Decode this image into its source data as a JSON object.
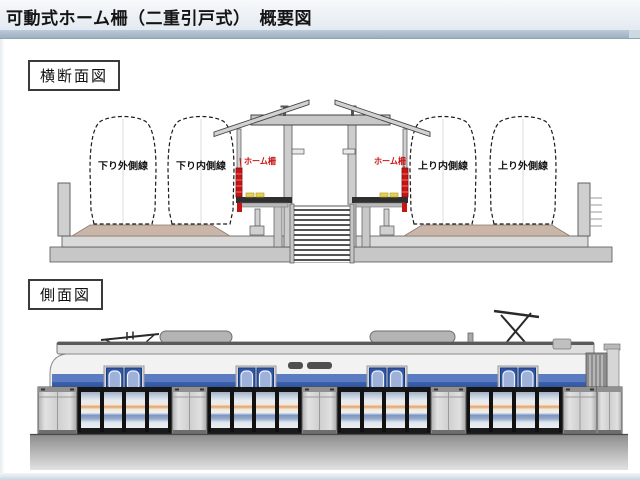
{
  "header": {
    "title": "可動式ホーム柵（二重引戸式）　概要図"
  },
  "cross_section": {
    "label": "横断面図",
    "tracks": [
      {
        "label": "下り外側線"
      },
      {
        "label": "下り内側線"
      },
      {
        "label": "上り内側線"
      },
      {
        "label": "上り外側線"
      }
    ],
    "fence_labels": {
      "left": "ホーム柵",
      "right": "ホーム柵"
    }
  },
  "side_view": {
    "label": "側面図"
  },
  "colors": {
    "header_band": "#a9bcca",
    "fence_red": "#c81414",
    "tactile_yellow": "#e6d050",
    "train_band_blue": "#24479c",
    "door_blue": "#2e55a8",
    "glass_orange_stripe": "#e2a36c",
    "glass_blue_stripe": "#7d95bf",
    "ballast_tan": "#c9b6a9",
    "structure_gray": "#cdcdcd"
  }
}
